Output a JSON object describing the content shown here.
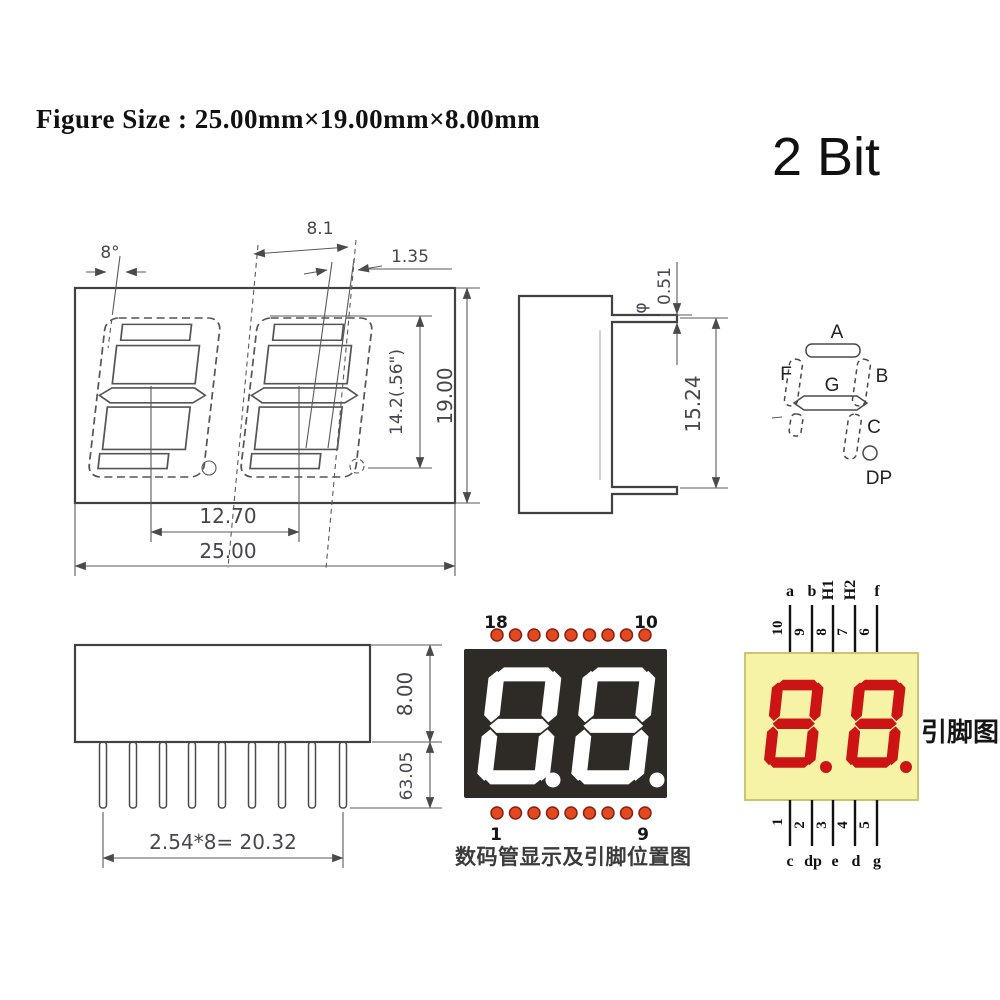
{
  "page": {
    "title": "Figure Size : 25.00mm×19.00mm×8.00mm",
    "bit_label": "2 Bit"
  },
  "front_view": {
    "angle_dim": "8°",
    "digit_width_dim": "8.1",
    "segment_dim": "1.35",
    "digit_height_dim": "14.2(.56\")",
    "body_height_dim": "19.00",
    "digit_pitch_dim": "12.70",
    "body_width_dim": "25.00"
  },
  "side_view": {
    "diameter_symbol": "φ",
    "pin_thickness_dim": "0.51",
    "depth_dim": "15.24"
  },
  "segment_map": {
    "a": "A",
    "b": "B",
    "c": "C",
    "f": "F",
    "g": "G",
    "dp": "DP"
  },
  "bottom_view": {
    "body_thickness_dim": "8.00",
    "pin_length_dim": "63.05",
    "pin_pitch_dim": "2.54*8= 20.32"
  },
  "display_photo": {
    "pin_top_left": "18",
    "pin_top_right": "10",
    "pin_bottom_left": "1",
    "pin_bottom_right": "9",
    "caption": "数码管显示及引脚位置图"
  },
  "pin_diagram": {
    "top_labels": [
      "a",
      "b",
      "H1",
      "H2",
      "f"
    ],
    "top_pin_numbers": [
      "10",
      "9",
      "8",
      "7",
      "6"
    ],
    "bottom_pin_numbers": [
      "1",
      "2",
      "3",
      "4",
      "5"
    ],
    "bottom_labels": [
      "c",
      "dp",
      "e",
      "d",
      "g"
    ],
    "caption": "引脚图"
  },
  "colors": {
    "drawing_line": "#4a4a4a",
    "display_body": "#2e2b27",
    "segment_white": "#ffffff",
    "pin_dot_fill": "#e2491f",
    "pin_dot_ring": "#8a2012",
    "diagram_body_fill": "#f6f2a6",
    "diagram_body_stroke": "#ccc470",
    "diagram_segment_red": "#cc1414"
  }
}
